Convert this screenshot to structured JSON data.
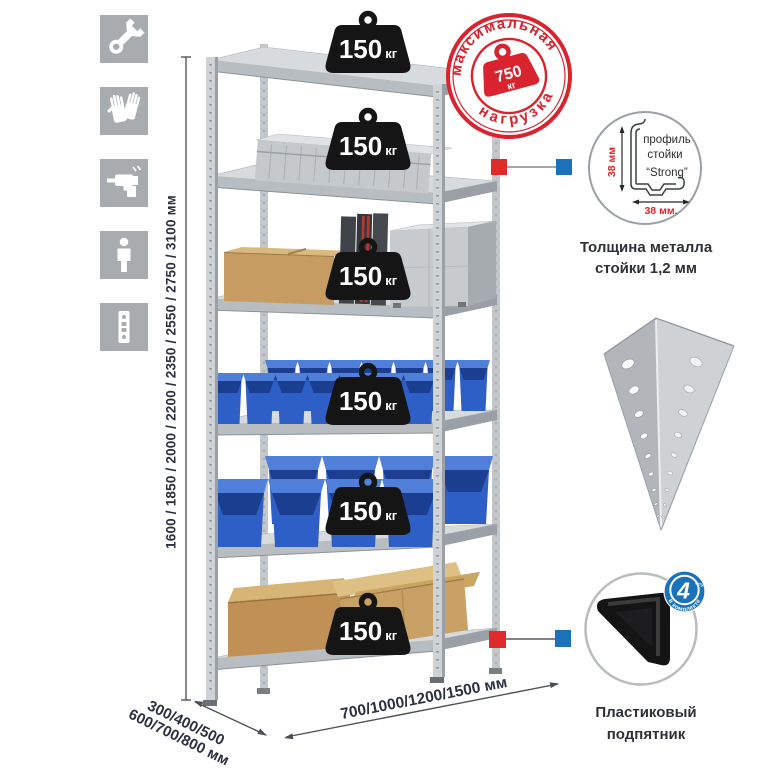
{
  "left_icons": [
    {
      "name": "wrench-icon"
    },
    {
      "name": "gloves-icon"
    },
    {
      "name": "drill-icon"
    },
    {
      "name": "person-icon"
    },
    {
      "name": "perforated-post-icon"
    }
  ],
  "dimensions": {
    "height": "1600 / 1850 / 2000 / 2200 / 2350 / 2550 / 2750 / 3100 мм",
    "depth_line1": "300/400/500",
    "depth_line2": "600/700/800 мм",
    "width": "700/1000/1200/1500 мм"
  },
  "rack": {
    "weights": [
      {
        "value": "150",
        "unit": "кг"
      },
      {
        "value": "150",
        "unit": "кг"
      },
      {
        "value": "150",
        "unit": "кг"
      },
      {
        "value": "150",
        "unit": "кг"
      },
      {
        "value": "150",
        "unit": "кг"
      },
      {
        "value": "150",
        "unit": "кг"
      }
    ]
  },
  "stamp": {
    "arc_top": "максимальная",
    "arc_bottom": "нагрузка",
    "value": "750",
    "unit": "кг"
  },
  "profile_detail": {
    "label_line1": "профиль",
    "label_line2": "стойки",
    "label_line3": "“Strong”",
    "dim_vertical": "38 мм",
    "dim_horizontal": "38 мм.",
    "caption_line1": "Толщина металла",
    "caption_line2": "стойки 1,2 мм"
  },
  "foot_detail": {
    "badge_number": "4",
    "badge_units": "штуки",
    "badge_arc": "в комплекте",
    "caption_line1": "Пластиковый",
    "caption_line2": "подпятник"
  },
  "colors": {
    "stamp_red": "#d9232e",
    "connector_red": "#e02b2b",
    "connector_blue": "#1a72bb",
    "bin_blue": "#2e5fc6",
    "icon_gray": "#a9acae",
    "dimension_text": "#2b3040"
  }
}
